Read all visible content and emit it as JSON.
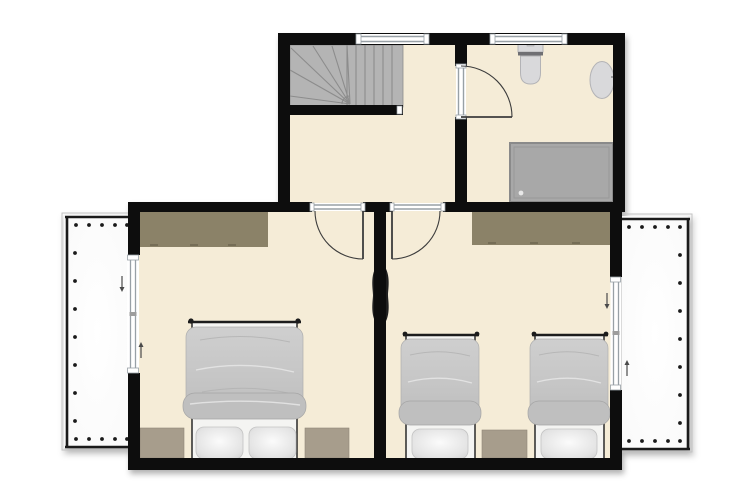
{
  "page": {
    "background": "#ffffff",
    "kind": "floor-plan"
  },
  "colors": {
    "page_bg": "#ffffff",
    "floor": "#f5ecd7",
    "wall": "#0d0d0d",
    "stairs": "#b4b4b4",
    "stair_line": "#8c8c8c",
    "wardrobe": "#8b8268",
    "nightstand": "#a79d8c",
    "shower": "#a8a8a8",
    "shower_border": "#8a8a8a",
    "fixture_light": "#d9d9db",
    "fixture_dark": "#6f6f73",
    "duvet_fold": "#bfbfbf",
    "bed_outline": "#1c1c1c",
    "tv": "#1f1f1f",
    "window_line": "#98a0a6",
    "door_line": "#3c3c3c",
    "balcony_rail": "#1a1a1a",
    "arrow": "#4a4a4a"
  },
  "rooms": [
    {
      "name": "stair-hall",
      "features": [
        "winder-staircase",
        "window"
      ]
    },
    {
      "name": "bathroom",
      "features": [
        "toilet",
        "washbasin",
        "shower",
        "hinged-door",
        "window"
      ]
    },
    {
      "name": "bedroom-left",
      "features": [
        "wardrobe",
        "double-bed",
        "nightstand",
        "nightstand",
        "wall-tv",
        "hinged-door",
        "sliding-door-to-balcony"
      ]
    },
    {
      "name": "bedroom-right",
      "features": [
        "wardrobe",
        "single-bed",
        "single-bed",
        "nightstand",
        "wall-tv",
        "hinged-door",
        "sliding-door-to-balcony"
      ]
    },
    {
      "name": "balcony-left",
      "features": [
        "railing-with-balusters"
      ]
    },
    {
      "name": "balcony-right",
      "features": [
        "railing-with-balusters"
      ]
    }
  ],
  "counts": {
    "windows_top_wall": 2,
    "hinged_doors": 3,
    "sliding_doors": 2,
    "beds_double": 1,
    "beds_single": 2,
    "nightstands": 3,
    "wardrobes": 2,
    "tvs": 2,
    "balconies": 2,
    "straight_treads": 6,
    "winder_treads": 5
  }
}
